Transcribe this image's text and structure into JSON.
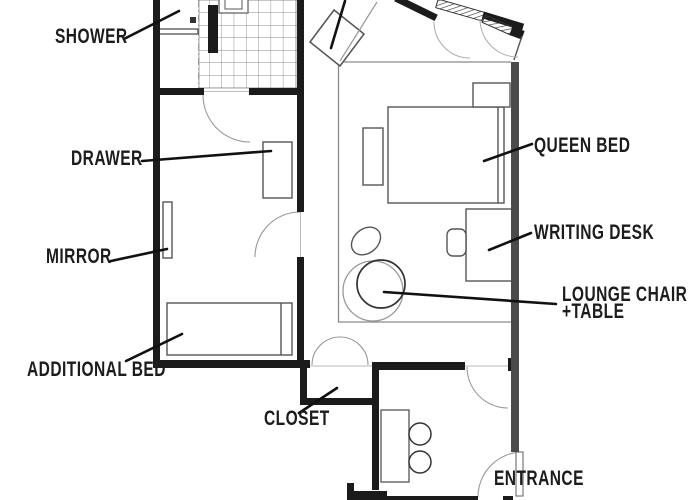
{
  "plan": {
    "type": "hotel-room-floor-plan",
    "labels": {
      "shower": "SHOWER",
      "drawer": "DRAWER",
      "mirror": "MIRROR",
      "additional_bed": "ADDITIONAL BED",
      "closet": "CLOSET",
      "queen_bed": "QUEEN BED",
      "writing_desk": "WRITING DESK",
      "lounge_chair_line1": "LOUNGE CHAIR",
      "lounge_chair_line2": "+TABLE",
      "entrance": "ENTRANCE"
    },
    "colors": {
      "background": "#ffffff",
      "wall": "#1b1b1b",
      "wall_gray": "#4a4a4a",
      "furniture_line": "#555555",
      "thin_line": "#8a8a8a",
      "tile_line": "#8c8c8c",
      "label_text": "#1c1c1c"
    }
  }
}
